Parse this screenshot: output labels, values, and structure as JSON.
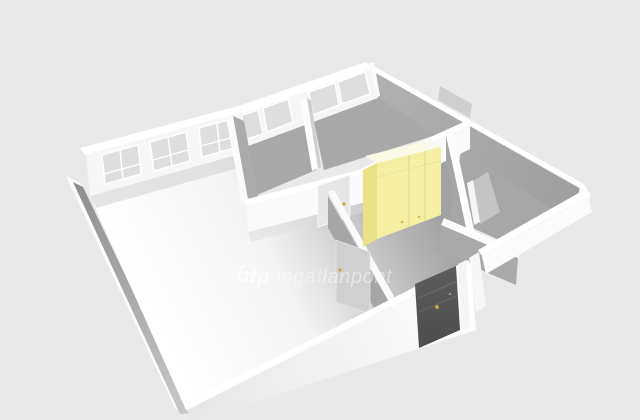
{
  "watermark": {
    "logo": "otp-ring-logo",
    "brand": "otp",
    "product": "ingatlanpont"
  },
  "colors": {
    "bg": "#e9e9e9",
    "wall_white": "#fafafa",
    "wall_top": "#ffffff",
    "wall_shadow": "#a7a7a7",
    "floor_light": "#f2f2f2",
    "floor_shadow": "#a8a8a8",
    "window_glass": "#dedede",
    "wardrobe_front": "#f5efa3",
    "wardrobe_side": "#e9e286",
    "wardrobe_top": "#fbf9e8",
    "door_dark": "#5d5d5d",
    "handle": "#c9a83c",
    "watermark_strong": "rgba(255,255,255,0.62)",
    "watermark_soft": "rgba(255,255,255,0.45)"
  },
  "scene": {
    "type": "3d-floorplan",
    "objects": [
      "living-room",
      "room-1",
      "room-2",
      "room-3",
      "room-4",
      "corridor",
      "wardrobe",
      "entrance-door",
      "interior-doors",
      "windows"
    ]
  }
}
